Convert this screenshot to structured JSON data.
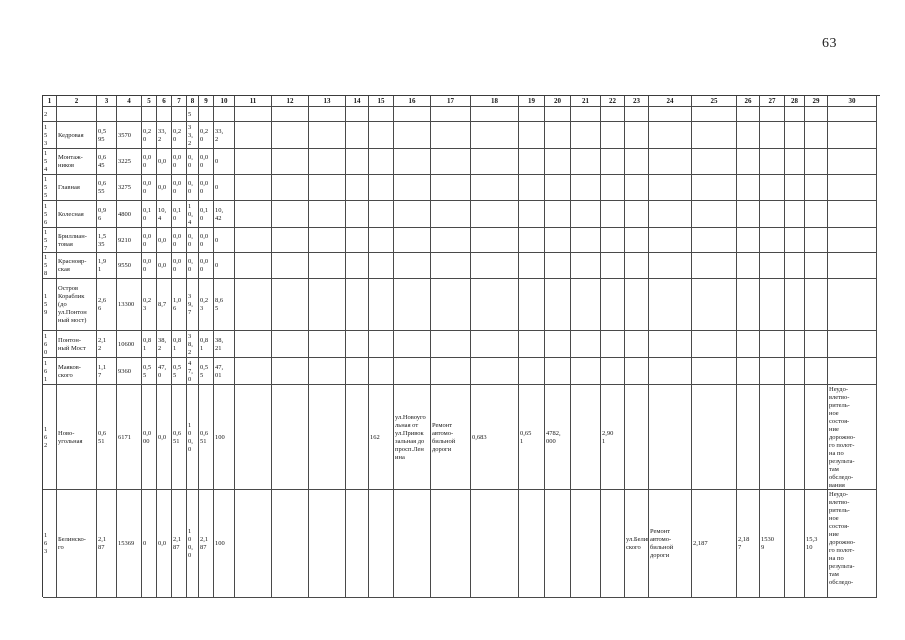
{
  "page": {
    "number": "63"
  },
  "table": {
    "header": [
      "1",
      "2",
      "3",
      "4",
      "5",
      "6",
      "7",
      "8",
      "9",
      "10",
      "11",
      "12",
      "13",
      "14",
      "15",
      "16",
      "17",
      "18",
      "19",
      "20",
      "21",
      "22",
      "23",
      "24",
      "25",
      "26",
      "27",
      "28",
      "29",
      "30"
    ],
    "rows": [
      [
        "2",
        "",
        "",
        "",
        "",
        "",
        "",
        "5",
        "",
        "",
        "",
        "",
        "",
        "",
        "",
        "",
        "",
        "",
        "",
        "",
        "",
        "",
        "",
        "",
        "",
        "",
        "",
        "",
        "",
        ""
      ],
      [
        "1\n5\n3",
        "Кедровая",
        "0,5\n95",
        "3570",
        "0,2\n0",
        "33,\n2",
        "0,2\n0",
        "3\n3,\n2",
        "0,2\n0",
        "33,\n2",
        "",
        "",
        "",
        "",
        "",
        "",
        "",
        "",
        "",
        "",
        "",
        "",
        "",
        "",
        "",
        "",
        "",
        "",
        "",
        ""
      ],
      [
        "1\n5\n4",
        "Монтаж-\nников",
        "0,6\n45",
        "3225",
        "0,0\n0",
        "0,0",
        "0,0\n0",
        "0,\n0",
        "0,0\n0",
        "0",
        "",
        "",
        "",
        "",
        "",
        "",
        "",
        "",
        "",
        "",
        "",
        "",
        "",
        "",
        "",
        "",
        "",
        "",
        "",
        ""
      ],
      [
        "1\n5\n5",
        "Главная",
        "0,6\n55",
        "3275",
        "0,0\n0",
        "0,0",
        "0,0\n0",
        "0,\n0",
        "0,0\n0",
        "0",
        "",
        "",
        "",
        "",
        "",
        "",
        "",
        "",
        "",
        "",
        "",
        "",
        "",
        "",
        "",
        "",
        "",
        "",
        "",
        ""
      ],
      [
        "1\n5\n6",
        "Колесная",
        "0,9\n6",
        "4800",
        "0,1\n0",
        "10,\n4",
        "0,1\n0",
        "1\n0,\n4",
        "0,1\n0",
        "10,\n42",
        "",
        "",
        "",
        "",
        "",
        "",
        "",
        "",
        "",
        "",
        "",
        "",
        "",
        "",
        "",
        "",
        "",
        "",
        "",
        ""
      ],
      [
        "1\n5\n7",
        "Бриллиан-\nтовая",
        "1,5\n35",
        "9210",
        "0,0\n0",
        "0,0",
        "0,0\n0",
        "0,\n0",
        "0,0\n0",
        "0",
        "",
        "",
        "",
        "",
        "",
        "",
        "",
        "",
        "",
        "",
        "",
        "",
        "",
        "",
        "",
        "",
        "",
        "",
        "",
        ""
      ],
      [
        "1\n5\n8",
        "Краснояр-\nская",
        "1,9\n1",
        "9550",
        "0,0\n0",
        "0,0",
        "0,0\n0",
        "0,\n0",
        "0,0\n0",
        "0",
        "",
        "",
        "",
        "",
        "",
        "",
        "",
        "",
        "",
        "",
        "",
        "",
        "",
        "",
        "",
        "",
        "",
        "",
        "",
        ""
      ],
      [
        "1\n5\n9",
        "Остров\nКораблик\n(до\nул.Понтон\nный мост)",
        "2,6\n6",
        "13300",
        "0,2\n3",
        "8,7",
        "1,0\n6",
        "3\n9,\n7",
        "0,2\n3",
        "8,6\n5",
        "",
        "",
        "",
        "",
        "",
        "",
        "",
        "",
        "",
        "",
        "",
        "",
        "",
        "",
        "",
        "",
        "",
        "",
        "",
        ""
      ],
      [
        "1\n6\n0",
        "Понтон-\nный Мост",
        "2,1\n2",
        "10600",
        "0,8\n1",
        "38,\n2",
        "0,8\n1",
        "3\n8,\n2",
        "0,8\n1",
        "38,\n21",
        "",
        "",
        "",
        "",
        "",
        "",
        "",
        "",
        "",
        "",
        "",
        "",
        "",
        "",
        "",
        "",
        "",
        "",
        "",
        ""
      ],
      [
        "1\n6\n1",
        "Маяков-\nского",
        "1,1\n7",
        "9360",
        "0,5\n5",
        "47,\n0",
        "0,5\n5",
        "4\n7,\n0",
        "0,5\n5",
        "47,\n01",
        "",
        "",
        "",
        "",
        "",
        "",
        "",
        "",
        "",
        "",
        "",
        "",
        "",
        "",
        "",
        "",
        "",
        "",
        "",
        ""
      ],
      [
        "1\n6\n2",
        "Ново-\nугольная",
        "0,6\n51",
        "6171",
        "0,0\n00",
        "0,0",
        "0,6\n51",
        "1\n0\n0,\n0",
        "0,6\n51",
        "100",
        "",
        "",
        "",
        "",
        "162",
        "ул.Новоуго\nльная от\nул.Привок\nзальная до\nпросп.Лен\nина",
        "Ремонт\nавтомо-\nбильной\nдороги",
        "0,683",
        "0,65\n1",
        "4782,\n000",
        "",
        "2,90\n1",
        "",
        "",
        "",
        "",
        "",
        "",
        "",
        "Неудо-\nвлетво-\nритель-\nное\nсостоя-\nние\nдорожно-\nго полот-\nна по\nрезульта-\nтам\nобследо-\nвания"
      ],
      [
        "1\n6\n3",
        "Белинско-\nго",
        "2,1\n87",
        "15369",
        "0",
        "0,0",
        "2,1\n87",
        "1\n0\n0,\n0",
        "2,1\n87",
        "100",
        "",
        "",
        "",
        "",
        "",
        "",
        "",
        "",
        "",
        "",
        "",
        "",
        "ул.Белин\nского",
        "Ремонт\nавтомо-\nбильной\nдороги",
        "2,187",
        "2,18\n7",
        "1530\n9",
        "",
        "15,3\n10",
        "Неудо-\nвлетво-\nритель-\nное\nсостоя-\nние\nдорожно-\nго полот-\nна по\nрезульта-\nтам\nобследо-"
      ]
    ]
  }
}
